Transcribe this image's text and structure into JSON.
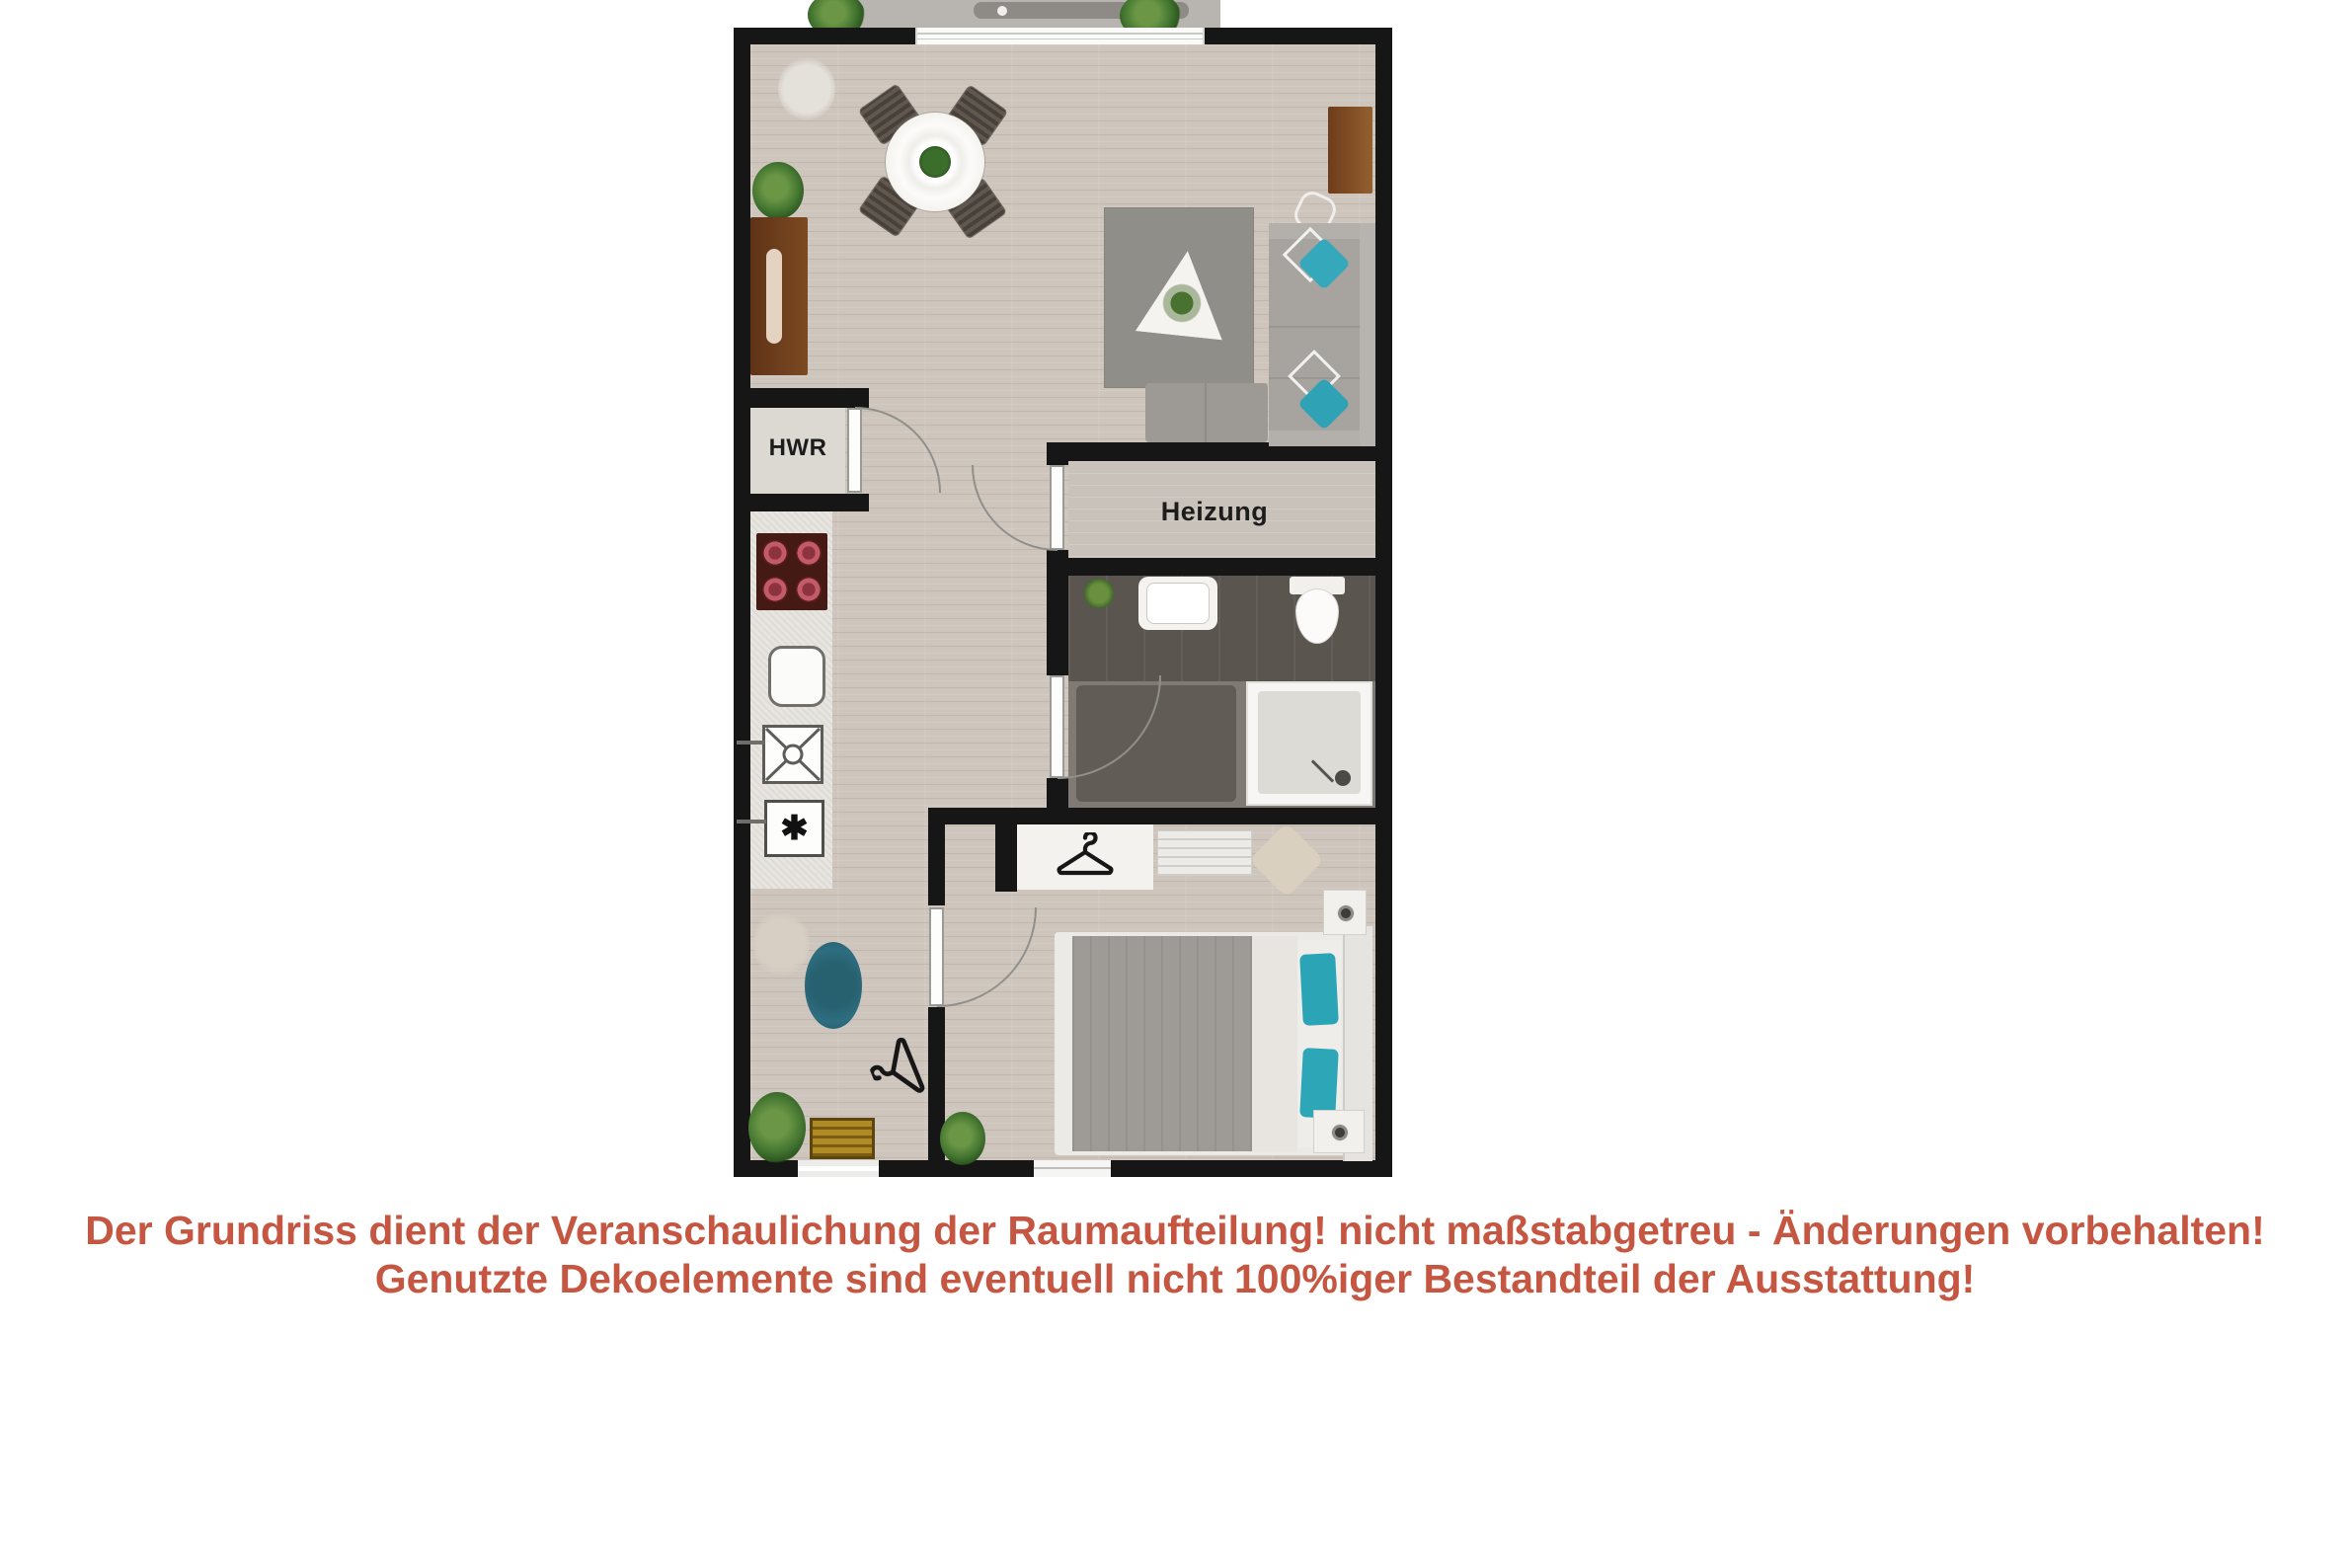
{
  "floorplan": {
    "labels": {
      "hwr": "HWR",
      "heizung": "Heizung"
    },
    "colors": {
      "wall": "#161616",
      "wood_floor": "#cec5bd",
      "bath_floor_dark": "#5b5550",
      "bath_floor_light": "#7f7a74",
      "living_rug": "#908e89",
      "hall_rug_blue": "#2e6e80",
      "sofa_grey": "#a7a49f",
      "pillow_teal": "#35a8bb",
      "bed_teal": "#2ba4b6",
      "furniture_brown": "#6b3d1e",
      "stove_red": "#b85565",
      "doormat_yellow": "#a8821f"
    },
    "icons": [
      "hanger-icon",
      "coat-hanger-icon",
      "oven-star-icon",
      "washer-cross-icon",
      "stove-burners-icon",
      "plant-icon",
      "door-swing-arc-icon"
    ]
  },
  "disclaimer": {
    "line1": "Der Grundriss dient der Veranschaulichung der Raumaufteilung! nicht maßstabgetreu - Änderungen vorbehalten!",
    "line2": "Genutzte Dekoelemente sind eventuell nicht 100%iger Bestandteil der Ausstattung!",
    "color": "#c55742"
  }
}
